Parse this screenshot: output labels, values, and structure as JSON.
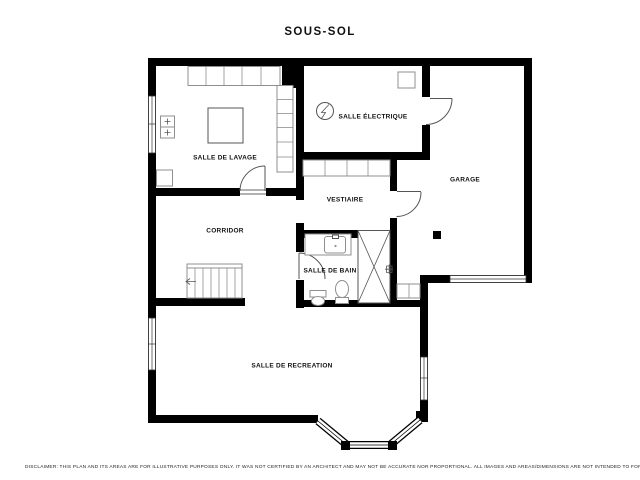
{
  "title": "SOUS-SOL",
  "rooms": {
    "lavage": {
      "label": "SALLE DE LAVAGE"
    },
    "electrique": {
      "label": "SALLE ÉLECTRIQUE"
    },
    "garage": {
      "label": "GARAGE"
    },
    "vestiaire": {
      "label": "VESTIAIRE"
    },
    "corridor": {
      "label": "CORRIDOR"
    },
    "bain": {
      "label": "SALLE DE BAIN"
    },
    "recreation": {
      "label": "SALLE DE RECREATION"
    }
  },
  "footer": {
    "disclaimer": "DISCLAIMER: THIS PLAN AND ITS AREAS ARE FOR ILLUSTRATIVE PURPOSES ONLY. IT WAS NOT CERTIFIED BY AN ARCHITECT AND MAY NOT BE ACCURATE NOR PROPORTIONAL. ALL IMAGES AND AREAS/DIMENSIONS ARE NOT INTENDED TO FORM ANY CONTRACT OR WARRANTY."
  },
  "colors": {
    "wall": "#000000",
    "fixture_stroke": "#8f8f8f",
    "label_text": "#111111",
    "background": "#ffffff"
  },
  "icons": {
    "electrical_panel": "lightning-bolt-in-circle",
    "stairs_direction": "left-arrow",
    "washer": "plus-square",
    "dryer": "plus-square",
    "shower": "x-cross-box",
    "structural_column": "solid-black-square"
  }
}
